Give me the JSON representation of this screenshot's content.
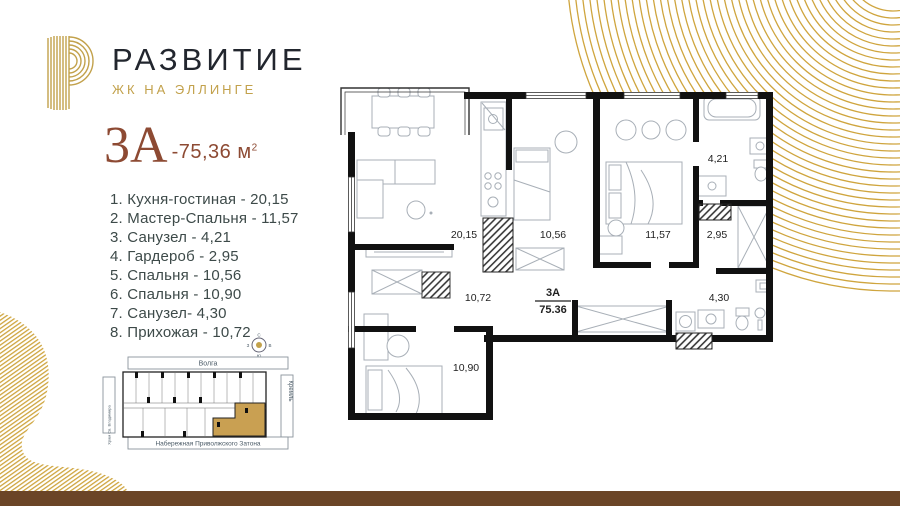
{
  "brand": {
    "title": "РАЗВИТИЕ",
    "subtitle": "ЖК НА ЭЛЛИНГЕ"
  },
  "apartment": {
    "unit": "3А",
    "area": "-75,36 м",
    "area_sup": "2"
  },
  "rooms": [
    {
      "label": "1. Кухня-гостиная - 20,15"
    },
    {
      "label": "2. Мастер-Спальня - 11,57"
    },
    {
      "label": "3. Санузел - 4,21"
    },
    {
      "label": "4. Гардероб - 2,95"
    },
    {
      "label": "5. Спальня - 10,56"
    },
    {
      "label": "6. Спальня - 10,90"
    },
    {
      "label": "7. Санузел- 4,30"
    },
    {
      "label": "8. Прихожая - 10,72"
    }
  ],
  "plan": {
    "unit": "3А",
    "total": "75.36",
    "labels": {
      "kitchen_living": "20,15",
      "bedroom1": "10,56",
      "master": "11,57",
      "bath1": "4,21",
      "wardrobe": "2,95",
      "bath2": "4,30",
      "hall": "10,72",
      "bedroom2": "10,90"
    }
  },
  "site": {
    "top": "Волга",
    "right": "Кремль",
    "left": "Храм Св. Владимира",
    "bottom": "Набережная Приволжского Затона",
    "compass": {
      "n": "С",
      "e": "В",
      "s": "Ю",
      "w": "З"
    }
  },
  "colors": {
    "gold": "#C2A14B",
    "deco_gold": "#CFA53E",
    "brick": "#8D4A33",
    "list_text": "#3D4A49",
    "brown_bar": "#6B4527",
    "highlight_unit": "#C9A052"
  }
}
